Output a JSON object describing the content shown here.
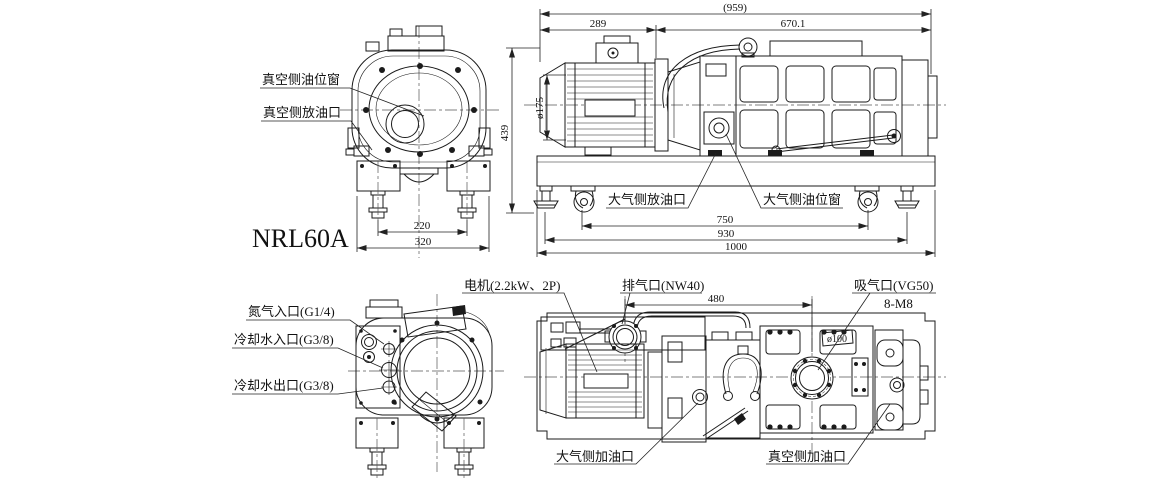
{
  "drawing": {
    "model": "NRL60A",
    "front_view": {
      "oil_window_label": "真空侧油位窗",
      "oil_drain_label": "真空侧放油口",
      "dim_feet": "220",
      "dim_width": "320"
    },
    "side_view": {
      "dim_overall": "(959)",
      "dim_motor": "289",
      "dim_body": "670.1",
      "dim_height": "439",
      "dim_motor_dia": "ø175",
      "atm_drain_label": "大气侧放油口",
      "atm_window_label": "大气侧油位窗",
      "dim_750": "750",
      "dim_930": "930",
      "dim_1000": "1000"
    },
    "rear_view": {
      "nitrogen_label": "氮气入口(G1/4)",
      "water_in_label": "冷却水入口(G3/8)",
      "water_out_label": "冷却水出口(G3/8)"
    },
    "top_view": {
      "motor_label": "电机(2.2kW、2P)",
      "exhaust_label": "排气口(NW40)",
      "suction_label": "吸气口(VG50)",
      "bolt_label": "8-M8",
      "dim_span": "480",
      "suction_dia": "ø100",
      "atm_fill_label": "大气侧加油口",
      "vac_fill_label": "真空侧加油口"
    }
  }
}
